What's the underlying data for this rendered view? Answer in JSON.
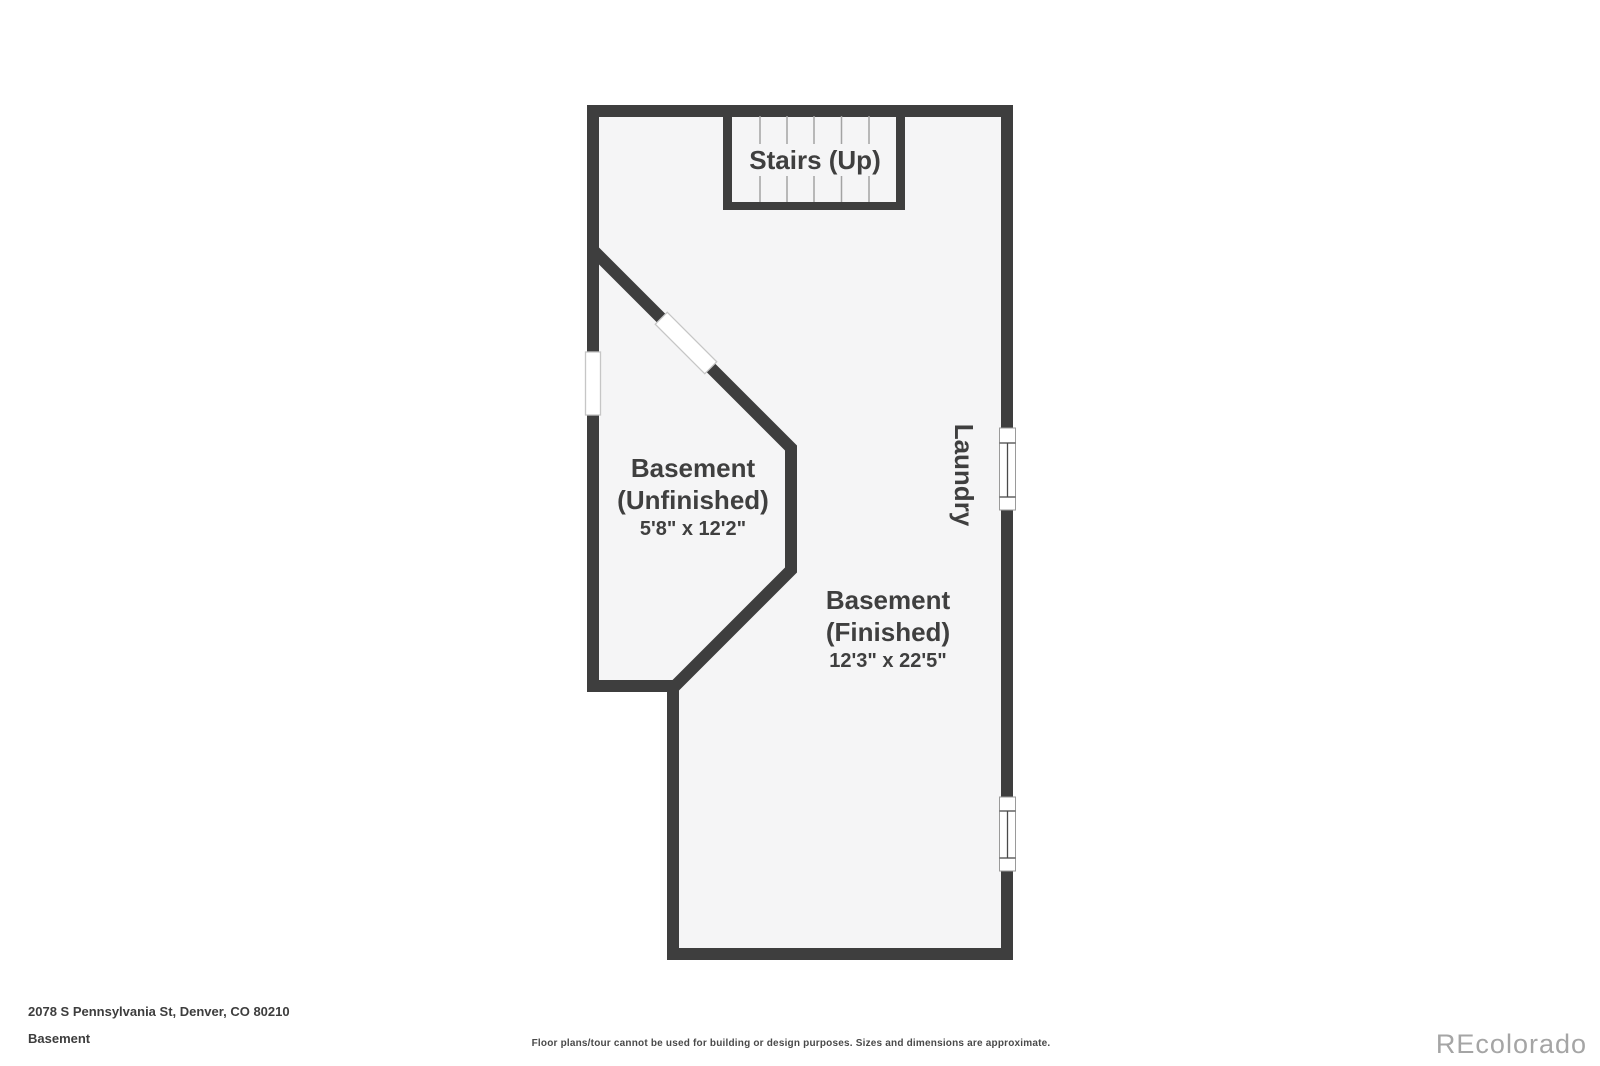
{
  "colors": {
    "wall": "#3e3e3e",
    "floor": "#f5f5f6",
    "background": "#ffffff",
    "tread_line": "#a3a3a3",
    "label_text": "#3f3f3f",
    "footer_text": "#3d3d3d",
    "disclaimer_text": "#4a4a4a",
    "watermark_text": "#a5a5a5"
  },
  "plan": {
    "stairs": {
      "label": "Stairs (Up)"
    },
    "laundry": {
      "label": "Laundry"
    },
    "rooms": [
      {
        "name_line1": "Basement",
        "name_line2": "(Unfinished)",
        "dimensions": "5'8\" x 12'2\""
      },
      {
        "name_line1": "Basement",
        "name_line2": "(Finished)",
        "dimensions": "12'3\" x 22'5\""
      }
    ]
  },
  "footer": {
    "address": "2078 S Pennsylvania St, Denver, CO 80210",
    "floor_label": "Basement",
    "disclaimer": "Floor plans/tour cannot be used for building or design purposes. Sizes and dimensions are approximate.",
    "watermark": "REcolorado"
  }
}
